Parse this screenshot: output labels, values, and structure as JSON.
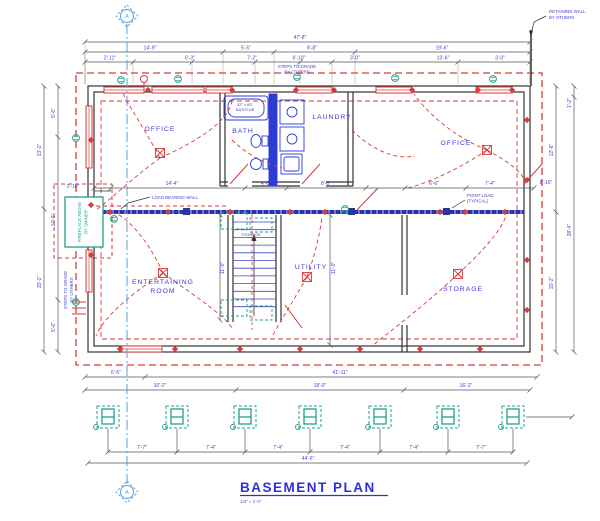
{
  "drawing": {
    "title": "BASEMENT PLAN",
    "scale": "1/4\" = 1'-0\"",
    "section_marker": "A",
    "colors": {
      "dimension_text_blue": "#4343d0",
      "room_label_blue": "#3a3ae0",
      "electrical_red": "#d93a3a",
      "footing_teal": "#1fa08c",
      "wall_black": "#333333",
      "fixture_blue": "#2d3bd3",
      "beam_blue": "#2a35a0",
      "section_line_blue": "#5d9fd4",
      "title_blue": "#2f2fe0"
    }
  },
  "rooms": {
    "office_left": "OFFICE",
    "bath": "BATH",
    "laundry": "LAUNDRY",
    "office_right": "OFFICE",
    "entertaining_line1": "ENTERTAINING",
    "entertaining_line2": "ROOM",
    "utility": "UTILITY",
    "storage": "STORAGE",
    "under_stair_storage": "STORAGE"
  },
  "annotations": {
    "retaining_wall_line1": "RETAINING WALL",
    "retaining_wall_line2": "BY OTHERS",
    "steps_top_line1": "STEPS TO GRADE",
    "steps_top_line2": "BY OTHERS",
    "steps_left_line1": "STEPS TO GRADE",
    "steps_left_line2": "BY OTHERS",
    "load_bearing_wall": "LOAD BEARING WALL",
    "point_load_line1": "POINT LOAD",
    "point_load_line2": "(TYPICAL)",
    "fireplace_line1": "FIREPLACE ABOVE",
    "fireplace_line2": "BY OWNER",
    "bathtub_line1": "32\" x 60\"",
    "bathtub_line2": "BATHTUB"
  },
  "dims": {
    "top": {
      "total": "47'-8\"",
      "row2": [
        "14'-9\"",
        "5'-5\"",
        "8'-8\"",
        "19'-6\""
      ],
      "row3": [
        "2'-11\"",
        "6'-3\"",
        "7'-2\"",
        "6'-10\"",
        "3'-0\"",
        "13'-6\"",
        "3'-0\""
      ]
    },
    "left": {
      "outer": [
        "13'-2\"",
        "15'-2\""
      ],
      "inner": [
        "5'-6\"",
        "17'-6\"",
        "5'-6\""
      ]
    },
    "right": {
      "top": "1'-2\"",
      "inner": [
        "12'-8\"",
        "15'-2\""
      ],
      "outer_total": "28'-4\"",
      "beam": "8'-10\""
    },
    "beam_row": [
      "1'-10\"",
      "14'-4\"",
      "4'-6\"",
      "8'-6\"",
      "6'-6\"",
      "7'-4\""
    ],
    "stair": [
      "11'-0\"",
      "11'-0\""
    ],
    "bottom": {
      "row1": [
        "6'-5\"",
        "41'-11\""
      ],
      "row2": [
        "16'-2\"",
        "18'-0\"",
        "16'-2\""
      ]
    },
    "footings": {
      "spacing": [
        "7'-7\"",
        "7'-4\"",
        "7'-4\"",
        "7'-4\"",
        "7'-4\"",
        "7'-7\""
      ],
      "total": "44'-6\""
    }
  }
}
